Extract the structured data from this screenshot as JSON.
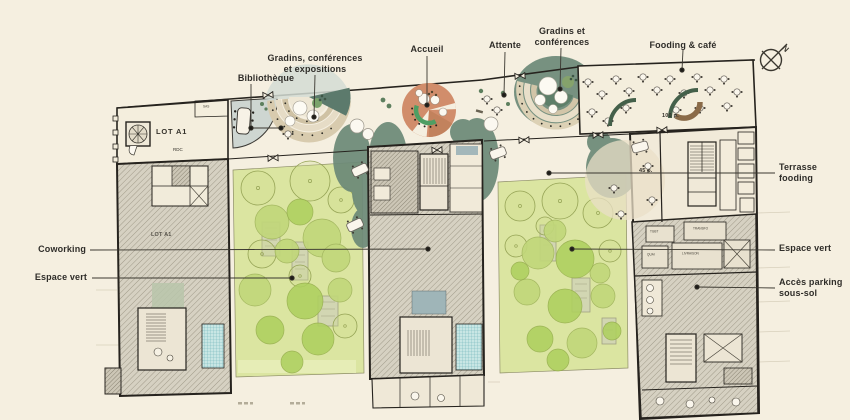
{
  "annotations": {
    "gradins_expo": {
      "line1": "Gradins, conférences",
      "line2": "et expositions"
    },
    "bibliotheque": {
      "line1": "Bibliothèque",
      "line2": ""
    },
    "accueil": {
      "line1": "Accueil",
      "line2": ""
    },
    "attente": {
      "line1": "Attente",
      "line2": ""
    },
    "gradins_conf": {
      "line1": "Gradins et",
      "line2": "conférences"
    },
    "fooding_cafe": {
      "line1": "Fooding & café",
      "line2": ""
    },
    "terrasse_fooding": {
      "line1": "Terrasse",
      "line2": "fooding"
    },
    "espace_vert_right": {
      "line1": "Espace vert",
      "line2": ""
    },
    "acces_parking": {
      "line1": "Accès parking",
      "line2": "sous-sol"
    },
    "coworking": {
      "line1": "Coworking",
      "line2": ""
    },
    "espace_vert_left": {
      "line1": "Espace vert",
      "line2": ""
    }
  },
  "plan_texts": {
    "lot_a1": "LOT A1",
    "rdc": "RDC",
    "sas": "SAS",
    "lot_a1_inner": "LOT A1",
    "capacity_100": "100 p.",
    "capacity_45": "45 p.",
    "tgbt": "TGBT",
    "transfo": "TRANSFO",
    "quai": "QUAI",
    "livraison": "LIVRAISON"
  },
  "compass": {
    "north_label": "N"
  },
  "colors": {
    "background": "#f5efe0",
    "wall": "#26231e",
    "building_fill": "#d6d1c2",
    "courtyard_green": "#dbe5a1",
    "tree_green": "#aed05f",
    "sage_tree": "#6d8a78",
    "reception_salmon": "#d18d6b",
    "bench_green": "#4f9e63",
    "banquette_green": "#44604a",
    "tiers_tan": "#d8cbae",
    "wet_room_teal": "#c8e6e4",
    "label_text": "#2f2d29"
  }
}
